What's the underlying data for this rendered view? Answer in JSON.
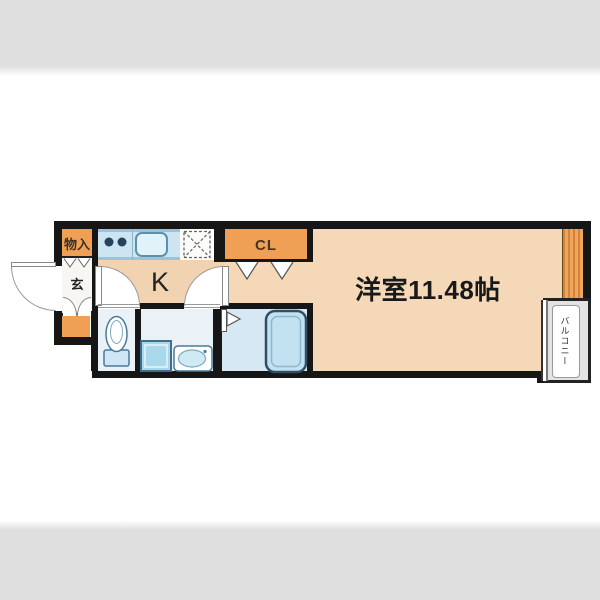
{
  "page": {
    "background": "#ffffff",
    "top_band_color": "#dfdfdf",
    "bottom_band_color": "#dfdfdf"
  },
  "floorplan": {
    "labels": {
      "storage": "物入",
      "entrance": "玄",
      "kitchen": "K",
      "closet": "CL",
      "main_room": "洋室11.48帖",
      "balcony": "バルコニー"
    },
    "colors": {
      "wall": "#161616",
      "accent_orange": "#efa055",
      "main_floor": "#f4d8b8",
      "kitchen_counter": "#cde4f1",
      "wet_area_floor": "#eaf1f7",
      "bathroom_floor": "#d6e8f3",
      "balcony_fill": "#e3e3e3"
    },
    "fixtures": [
      "stove-burners-icon",
      "kitchen-sink-icon",
      "refrigerator-space-icon",
      "toilet-icon",
      "washing-machine-icon",
      "washbasin-icon",
      "bathtub-icon",
      "entrance-door-icon",
      "kitchen-door-icons",
      "closet-bifold-door-icons",
      "bathroom-folding-door-icon",
      "balcony-window-icon"
    ]
  }
}
